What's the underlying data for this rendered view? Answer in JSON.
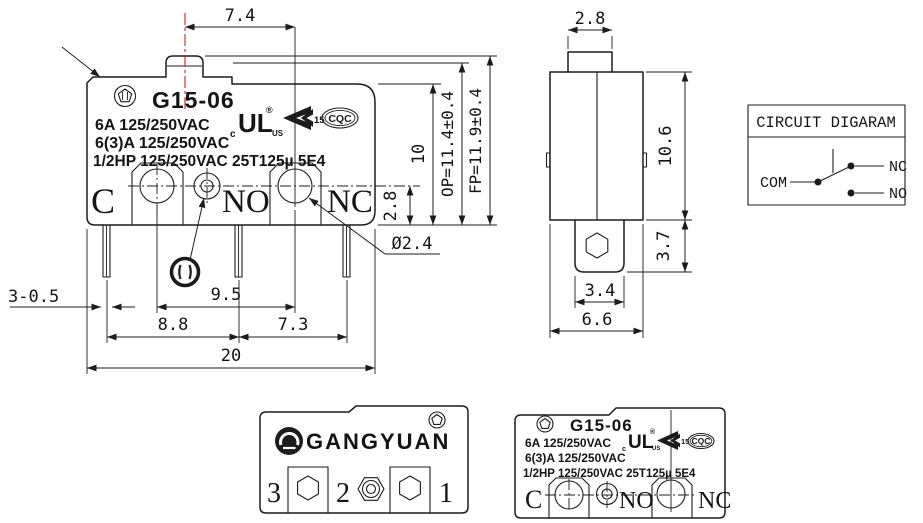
{
  "colors": {
    "background": "#ffffff",
    "line": "#1c1c1c",
    "centerline_red": "#cc2222"
  },
  "front_view": {
    "model": "G15-06",
    "marking_lines": [
      "6A 125/250VAC",
      "6(3)A 125/250VAC",
      "1/2HP 125/250VAC 25T125µ 5E4"
    ],
    "terminal_labels": {
      "com": "C",
      "no": "NO",
      "nc": "NC"
    },
    "certs": {
      "ul": "UL",
      "ul_c": "c",
      "ul_us": "US",
      "ul_reg": "®",
      "k_number": "15",
      "cqc": "CQC"
    },
    "dimensions": {
      "plunger_offset": "7.4",
      "body_height": "10",
      "operating_position": "OP=11.4±0.4",
      "free_position": "FP=11.9±0.4",
      "base_strip_height": "2.8",
      "hole_diameter": "Ø2.4",
      "terminal_spec": "3-0.5",
      "mount_hole_pitch": "9.5",
      "pin_pitch_left": "8.8",
      "pin_pitch_right": "7.3",
      "overall_width": "20"
    }
  },
  "side_view": {
    "dimensions": {
      "plunger_width": "2.8",
      "body_height": "10.6",
      "terminal_length": "3.7",
      "terminal_width": "3.4",
      "body_depth": "6.6"
    }
  },
  "circuit_diagram": {
    "title": "CIRCUIT DIGARAM",
    "com": "COM",
    "nc": "NC",
    "no": "NO"
  },
  "back_view": {
    "brand": "GANGYUAN",
    "pins": [
      "3",
      "2",
      "1"
    ]
  }
}
